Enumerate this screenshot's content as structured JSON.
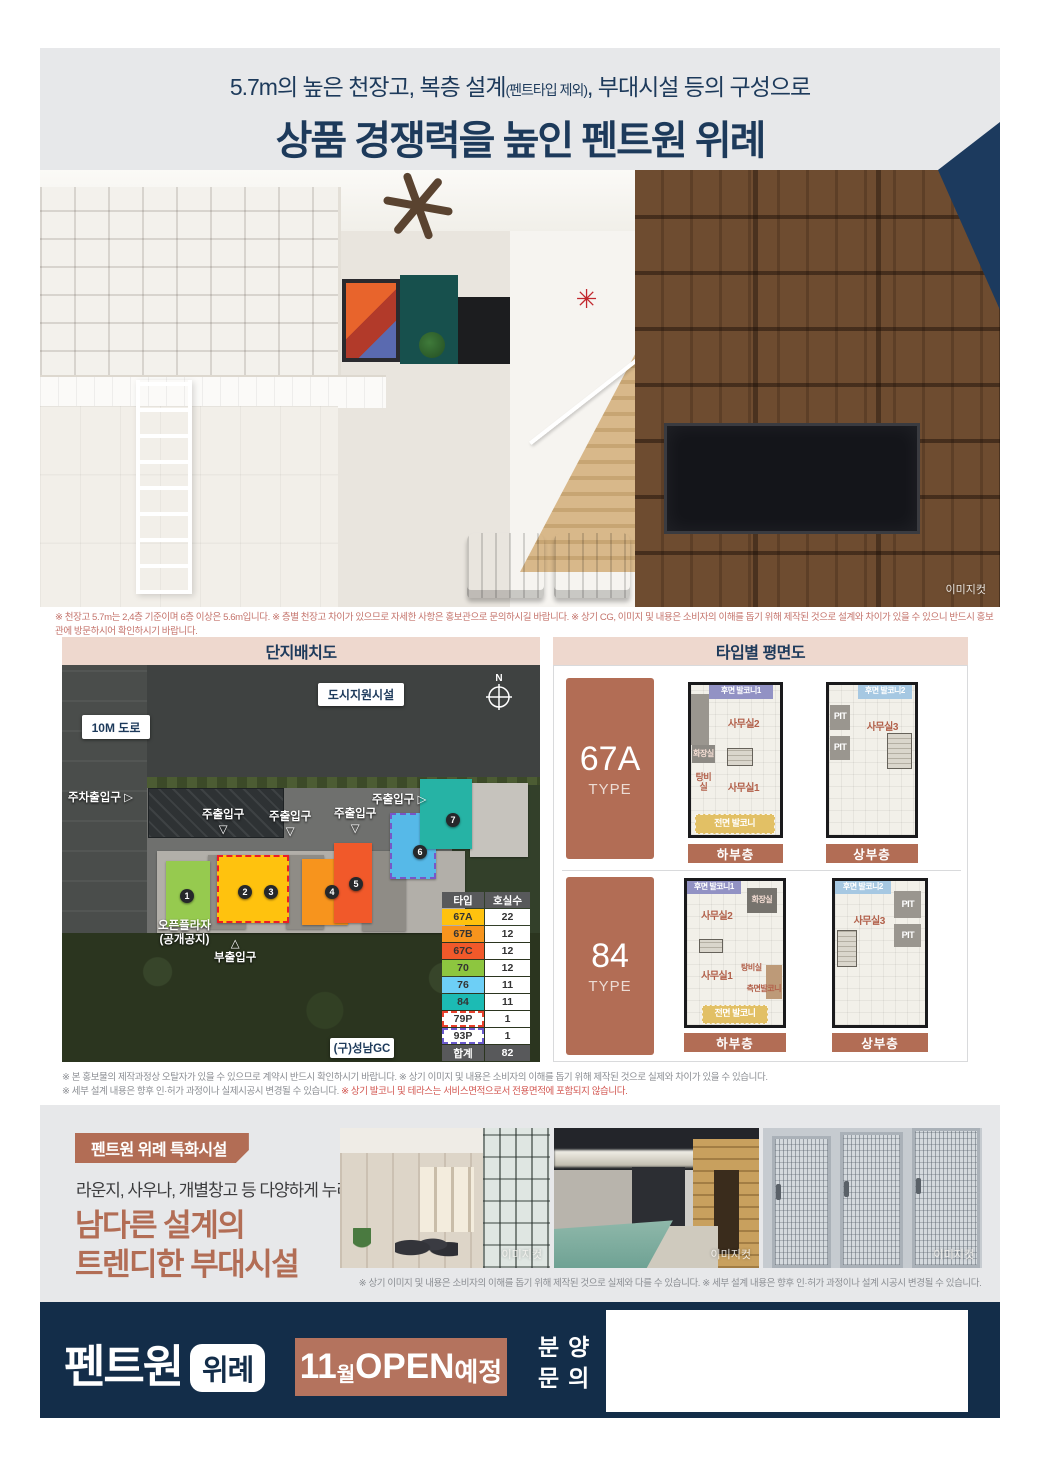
{
  "header": {
    "line1_pre": "5.7m의 높은 천장고, 복층 설계",
    "line1_small": "(펜트타입 제외)",
    "line1_post": ", 부대시설 등의 구성으로",
    "line2": "상품 경쟁력을 높인 펜트원 위례"
  },
  "hero": {
    "watermark": "이미지컷",
    "disclaimer": "※ 천장고 5.7m는 2,4층 기준이며 6층 이상은 5.6m입니다. ※ 층별 천장고 차이가 있으므로 자세한 사항은 홍보관으로 문의하시길 바랍니다. ※ 상기 CG, 이미지 및 내용은 소비자의 이해를 돕기 위해 제작된 것으로 설계와 차이가 있을 수 있으니 반드시 홍보관에 방문하시어 확인하시기 바랍니다."
  },
  "site_plan": {
    "title": "단지배치도",
    "labels": {
      "city_support": "도시지원시설",
      "road": "10M 도로",
      "parking_entrance": "주차출입구",
      "main_entrance": "주출입구",
      "open_plaza1": "오픈플라자",
      "open_plaza2": "(공개공지)",
      "sub_entrance": "부출입구",
      "gc": "(구)성남GC",
      "compass_n": "N",
      "arrow_right": "▷",
      "arrow_down": "▽",
      "arrow_up": "△"
    },
    "blocks": [
      {
        "x": 95,
        "y": 186,
        "w": 308,
        "h": 82,
        "bg": "#b2afa9"
      },
      {
        "x": 146,
        "y": 190,
        "w": 38,
        "h": 74,
        "bg": "#8f8c86"
      },
      {
        "x": 224,
        "y": 190,
        "w": 38,
        "h": 74,
        "bg": "#8f8c86"
      },
      {
        "x": 300,
        "y": 186,
        "w": 44,
        "h": 80,
        "bg": "#8f8c86"
      },
      {
        "x": 408,
        "y": 118,
        "w": 58,
        "h": 74,
        "bg": "#c6c3bd"
      },
      {
        "x": 104,
        "y": 196,
        "w": 44,
        "h": 66,
        "bg": "#96ca4f"
      },
      {
        "x": 155,
        "y": 190,
        "w": 72,
        "h": 68,
        "bg": "#ffc20e",
        "border": "2px dashed #ed1c24"
      },
      {
        "x": 240,
        "y": 194,
        "w": 46,
        "h": 66,
        "bg": "#f7941d"
      },
      {
        "x": 272,
        "y": 178,
        "w": 38,
        "h": 80,
        "bg": "#f1592a"
      },
      {
        "x": 328,
        "y": 148,
        "w": 46,
        "h": 66,
        "bg": "#56b9e8",
        "border": "2px dashed #7757c8"
      },
      {
        "x": 358,
        "y": 114,
        "w": 52,
        "h": 70,
        "bg": "#26b3a5"
      }
    ],
    "markers": [
      {
        "no": "1",
        "x": 118,
        "y": 224
      },
      {
        "no": "2",
        "x": 176,
        "y": 220
      },
      {
        "no": "3",
        "x": 202,
        "y": 220
      },
      {
        "no": "4",
        "x": 263,
        "y": 220
      },
      {
        "no": "5",
        "x": 287,
        "y": 212
      },
      {
        "no": "6",
        "x": 351,
        "y": 180
      },
      {
        "no": "7",
        "x": 384,
        "y": 148
      }
    ],
    "table": {
      "headers": [
        "타입",
        "호실수"
      ],
      "rows": [
        {
          "type": "67A",
          "count": "22",
          "bg": "#ffc20e"
        },
        {
          "type": "67B",
          "count": "12",
          "bg": "#f7941d"
        },
        {
          "type": "67C",
          "count": "12",
          "bg": "#f1592a"
        },
        {
          "type": "70",
          "count": "12",
          "bg": "#8dc63f"
        },
        {
          "type": "76",
          "count": "11",
          "bg": "#6dcff6"
        },
        {
          "type": "84",
          "count": "11",
          "bg": "#1cbbb4"
        },
        {
          "type": "79P",
          "count": "1",
          "bg": "#ffffff",
          "border": "2px dashed #e8402c"
        },
        {
          "type": "93P",
          "count": "1",
          "bg": "#ffffff",
          "border": "2px dashed #6a5acd"
        },
        {
          "type": "합계",
          "count": "82",
          "bg": "#58595b",
          "fg": "#ffffff",
          "total": true
        }
      ]
    }
  },
  "floor_plans": {
    "title": "타입별 평면도",
    "types": [
      {
        "name": "67A",
        "type_label": "TYPE",
        "lower": {
          "caption": "하부층",
          "rooms": [
            {
              "label": "",
              "x": 0,
              "y": 6,
              "w": 20,
              "h": 34,
              "bg": "#9a968f"
            },
            {
              "label": "후면 발코니1",
              "x": 20,
              "y": 0,
              "w": 72,
              "h": 9,
              "bg": "#9292c4",
              "color": "#ffffff",
              "fs": 8
            },
            {
              "label": "사무실2",
              "x": 22,
              "y": 11,
              "w": 74,
              "h": 30,
              "color": "#b2604a",
              "fs": 10
            },
            {
              "label": "화장실",
              "x": 1,
              "y": 40,
              "w": 26,
              "h": 12,
              "bg": "#8d8a84",
              "color": "#f5ded4",
              "fs": 8
            },
            {
              "label": "",
              "x": 40,
              "y": 42,
              "w": 30,
              "h": 12,
              "stairs": true
            },
            {
              "label": "탕비실",
              "x": 1,
              "y": 60,
              "w": 26,
              "h": 11,
              "color": "#b2604a",
              "fs": 9
            },
            {
              "label": "사무실1",
              "x": 28,
              "y": 56,
              "w": 62,
              "h": 26,
              "color": "#b2604a",
              "fs": 10
            },
            {
              "label": "전면 발코니",
              "x": 4,
              "y": 86,
              "w": 90,
              "h": 13,
              "bg": "#e2c065",
              "color": "#ffffff",
              "fs": 9,
              "dash": true
            }
          ]
        },
        "upper": {
          "caption": "상부층",
          "rooms": [
            {
              "label": "후면 발코니2",
              "x": 34,
              "y": 0,
              "w": 62,
              "h": 9,
              "bg": "#a6c8e2",
              "color": "#ffffff",
              "fs": 8
            },
            {
              "label": "PIT",
              "x": 1,
              "y": 13,
              "w": 24,
              "h": 17,
              "bg": "#9a968f",
              "color": "#ffffff",
              "fs": 9
            },
            {
              "label": "PIT",
              "x": 1,
              "y": 34,
              "w": 24,
              "h": 16,
              "bg": "#9a968f",
              "color": "#ffffff",
              "fs": 9
            },
            {
              "label": "사무실3",
              "x": 30,
              "y": 12,
              "w": 64,
              "h": 32,
              "color": "#b2604a",
              "fs": 10
            },
            {
              "label": "",
              "x": 68,
              "y": 32,
              "w": 28,
              "h": 24,
              "stairs": true
            }
          ]
        }
      },
      {
        "name": "84",
        "type_label": "TYPE",
        "lower": {
          "caption": "하부층",
          "rooms": [
            {
              "label": "후면 발코니1",
              "x": 0,
              "y": 0,
              "w": 56,
              "h": 9,
              "bg": "#9292c4",
              "color": "#ffffff",
              "fs": 8
            },
            {
              "label": "화장실",
              "x": 62,
              "y": 5,
              "w": 32,
              "h": 17,
              "bg": "#76736d",
              "color": "#f5ded4",
              "fs": 8
            },
            {
              "label": "사무실2",
              "x": 6,
              "y": 12,
              "w": 50,
              "h": 26,
              "color": "#b2604a",
              "fs": 10
            },
            {
              "label": "",
              "x": 12,
              "y": 40,
              "w": 26,
              "h": 10,
              "stairs": true
            },
            {
              "label": "사무실1",
              "x": 6,
              "y": 52,
              "w": 50,
              "h": 28,
              "color": "#b2604a",
              "fs": 10
            },
            {
              "label": "탕비실",
              "x": 56,
              "y": 54,
              "w": 22,
              "h": 13,
              "color": "#b2604a",
              "fs": 8
            },
            {
              "label": "",
              "x": 82,
              "y": 58,
              "w": 17,
              "h": 24,
              "bg": "#bd9a78"
            },
            {
              "label": "측면발코니",
              "x": 60,
              "y": 70,
              "w": 40,
              "h": 10,
              "color": "#b2604a",
              "fs": 8
            },
            {
              "label": "전면 발코니",
              "x": 16,
              "y": 86,
              "w": 68,
              "h": 13,
              "bg": "#e2c065",
              "color": "#ffffff",
              "fs": 9,
              "dash": true
            }
          ]
        },
        "upper": {
          "caption": "상부층",
          "rooms": [
            {
              "label": "후면 발코니2",
              "x": 0,
              "y": 0,
              "w": 62,
              "h": 9,
              "bg": "#a6c8e2",
              "color": "#ffffff",
              "fs": 8
            },
            {
              "label": "PIT",
              "x": 66,
              "y": 7,
              "w": 30,
              "h": 19,
              "bg": "#9a968f",
              "color": "#ffffff",
              "fs": 9
            },
            {
              "label": "PIT",
              "x": 66,
              "y": 30,
              "w": 30,
              "h": 16,
              "bg": "#9a968f",
              "color": "#ffffff",
              "fs": 9
            },
            {
              "label": "사무실3",
              "x": 12,
              "y": 12,
              "w": 52,
              "h": 32,
              "color": "#b2604a",
              "fs": 10
            },
            {
              "label": "",
              "x": 2,
              "y": 34,
              "w": 22,
              "h": 26,
              "stairs": true
            }
          ]
        }
      }
    ]
  },
  "mid_disclaimer": {
    "line1": "※ 본 홍보물의 제작과정상 오탈자가 있을 수 있으므로 계약시 반드시 확인하시기 바랍니다. ※ 상기 이미지 및 내용은 소비자의 이해를 돕기 위해 제작된 것으로 실제와 차이가 있을 수 있습니다.",
    "line2_gray": "※ 세부 설계 내용은 향후 인·허가 과정이나 실제시공시 변경될 수 있습니다. ",
    "line2_red": "※ 상기 발코니 및 테라스는 서비스면적으로서 전용면적에 포함되지 않습니다."
  },
  "amenities": {
    "badge": "펜트원 위례 특화시설",
    "subtitle": "라운지, 사우나, 개별창고 등 다양하게 누리는",
    "headline1": "남다른 설계의",
    "headline2": "트렌디한 부대시설",
    "photos": [
      {
        "name": "lounge",
        "watermark": "이미지컷"
      },
      {
        "name": "pool-sauna",
        "watermark": "이미지컷"
      },
      {
        "name": "storage",
        "watermark": "이미지컷"
      }
    ],
    "disclaimer": "※ 상기 이미지 및 내용은 소비자의 이해를 돕기 위해 제작된 것으로 실제와 다를 수 있습니다. ※ 세부 설계 내용은 향후 인·허가 과정이나 설계 시공시 변경될 수 있습니다."
  },
  "footer": {
    "brand": "펜트원",
    "brand_badge": "위례",
    "open_num": "11",
    "open_wol": "월",
    "open_main": " OPEN",
    "open_suffix": "예정",
    "contact1": "분양",
    "contact2": "문의"
  },
  "colors": {
    "navy": "#1c3a5e",
    "terracotta": "#b26d55",
    "panel_header_pink": "#eed8ce",
    "section_gray": "#e7e8ea",
    "disclaimer_red": "#c4736b"
  }
}
